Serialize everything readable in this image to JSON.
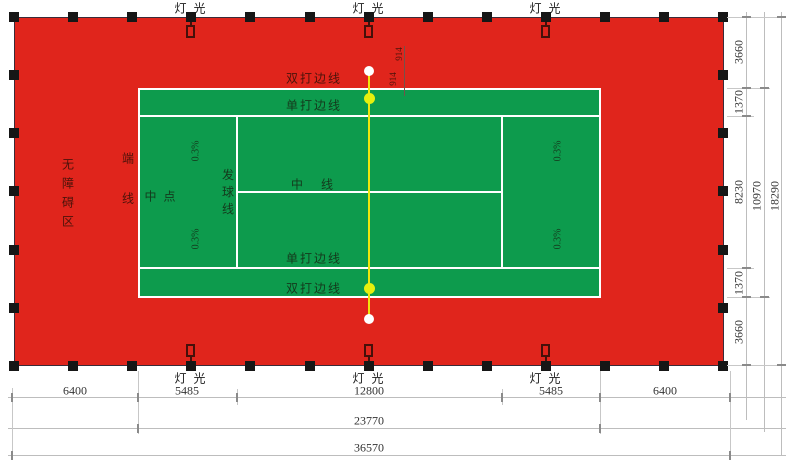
{
  "drawing": {
    "type": "tennis-court-plan"
  },
  "labels": {
    "light": "灯 光",
    "barrier_free_zone": "无障碍区",
    "end_line": "端线",
    "center_mark": "中 点",
    "service_line": "发球线",
    "center_line": "中      线",
    "singles_sideline": "单打边线",
    "doubles_sideline": "双打边线",
    "slope": "0.3%",
    "net_post_offset": "914"
  },
  "dimensions": {
    "horizontal_segments": [
      "6400",
      "5485",
      "12800",
      "5485",
      "6400"
    ],
    "horizontal_court_total": "23770",
    "horizontal_overall": "36570",
    "vertical_segments": [
      "3660",
      "1370",
      "8230",
      "1370",
      "3660"
    ],
    "vertical_court_total": "10970",
    "vertical_overall": "18290"
  },
  "colors": {
    "surround": "#e0251c",
    "court": "#0d9b4d",
    "court_lines": "#ffffff",
    "net_line": "#f0e60c",
    "marker_yellow": "#e6f00e"
  }
}
